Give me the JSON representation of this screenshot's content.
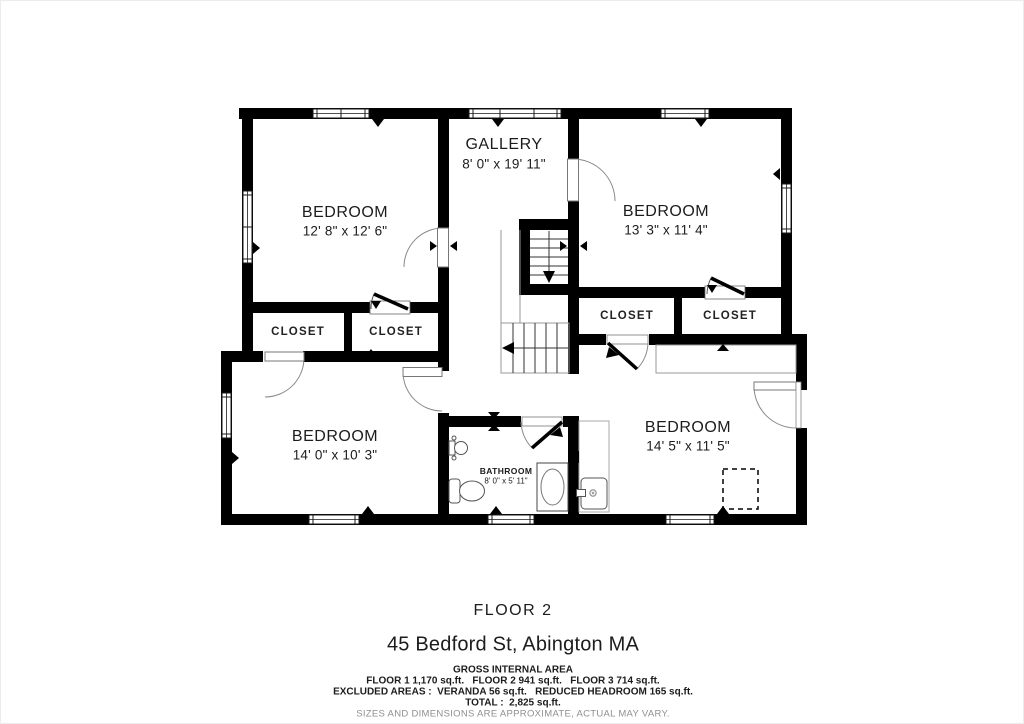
{
  "rooms": {
    "bedroom1": {
      "name": "BEDROOM",
      "dims": "12' 8\" x 12' 6\""
    },
    "gallery": {
      "name": "GALLERY",
      "dims": "8' 0\" x 19' 11\""
    },
    "bedroom2": {
      "name": "BEDROOM",
      "dims": "13' 3\" x 11' 4\""
    },
    "bedroom3": {
      "name": "BEDROOM",
      "dims": "14' 0\" x 10' 3\""
    },
    "bathroom": {
      "name": "BATHROOM",
      "dims": "8' 0\" x 5' 11\""
    },
    "bedroom4": {
      "name": "BEDROOM",
      "dims": "14' 5\" x 11' 5\""
    },
    "closet1": {
      "name": "CLOSET"
    },
    "closet2": {
      "name": "CLOSET"
    },
    "closet3": {
      "name": "CLOSET"
    },
    "closet4": {
      "name": "CLOSET"
    }
  },
  "footer": {
    "floor_label": "FLOOR 2",
    "address": "45 Bedford St, Abington MA",
    "area_title": "GROSS INTERNAL AREA",
    "area_line1": "FLOOR 1 1,170 sq.ft.   FLOOR 2 941 sq.ft.   FLOOR 3 714 sq.ft.",
    "area_line2": "EXCLUDED AREAS :  VERANDA 56 sq.ft.   REDUCED HEADROOM 165 sq.ft.",
    "area_line3": "TOTAL :  2,825 sq.ft.",
    "disclaimer": "SIZES AND DIMENSIONS ARE APPROXIMATE, ACTUAL MAY VARY."
  },
  "icons": {
    "fixtures": [
      "sink-icon",
      "toilet-icon",
      "bathtub-icon",
      "shower-icon",
      "stairs-icon"
    ]
  },
  "colors": {
    "wall": "#000000",
    "door_arc": "#8a8a8a",
    "thin_line": "#999999",
    "muted_text": "#8f8f8f"
  }
}
